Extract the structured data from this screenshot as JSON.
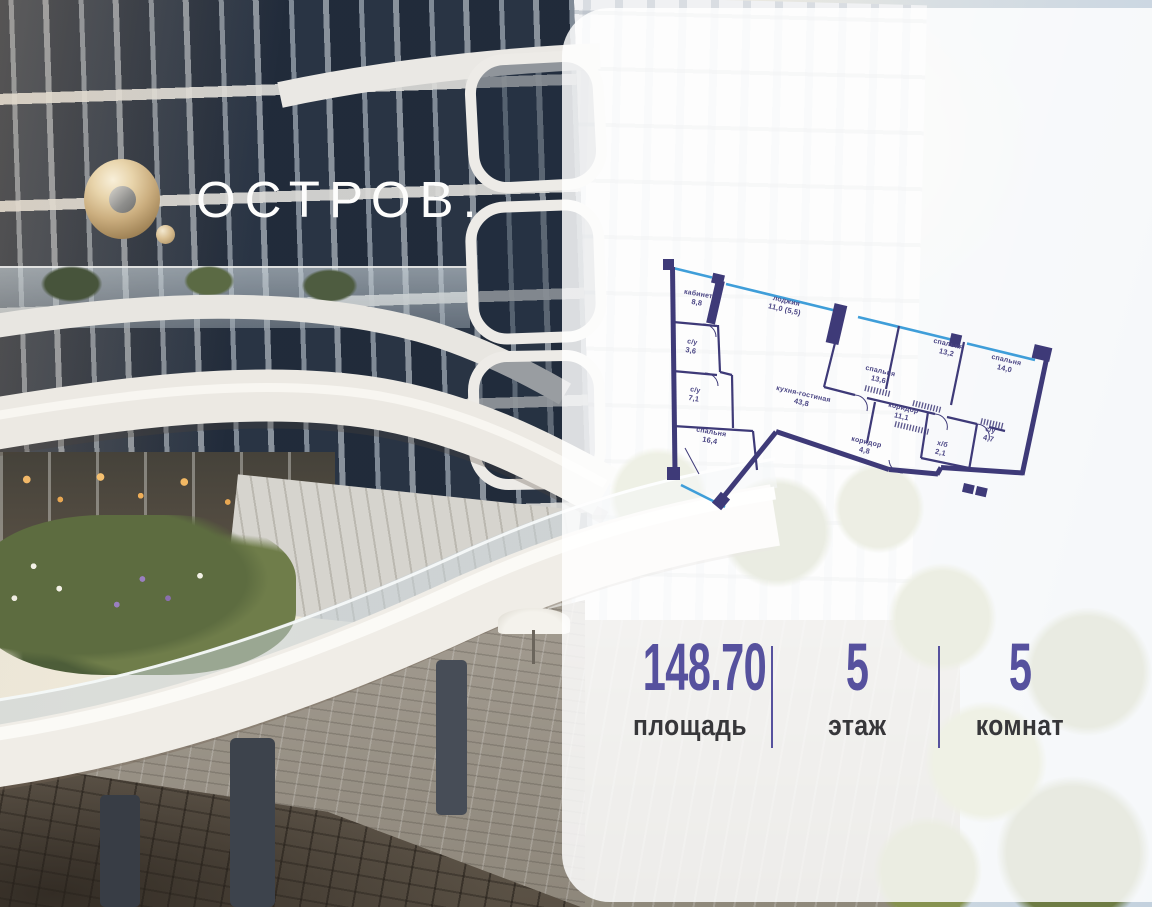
{
  "brand": {
    "wordmark": "ОСТРОВ."
  },
  "colors": {
    "wall": "#3e3a78",
    "window": "#3f9ed9",
    "accent": "#56519e",
    "room_label": "#4b4685",
    "stat_label": "#37373a",
    "gold": "#c9ab7e"
  },
  "floorplan": {
    "rooms": [
      {
        "name": "кабинет",
        "area": "8,8"
      },
      {
        "name": "лоджия",
        "area": "11,0 (5,5)"
      },
      {
        "name": "с/у",
        "area": "3,6"
      },
      {
        "name": "с/у",
        "area": "7,1"
      },
      {
        "name": "спальня",
        "area": "16,4"
      },
      {
        "name": "кухня-гостиная",
        "area": "43,8"
      },
      {
        "name": "спальня",
        "area": "13,6"
      },
      {
        "name": "спальня",
        "area": "13,2"
      },
      {
        "name": "спальня",
        "area": "14,0"
      },
      {
        "name": "коридор",
        "area": "11,1"
      },
      {
        "name": "коридор",
        "area": "4,8"
      },
      {
        "name": "х/б",
        "area": "2,1"
      },
      {
        "name": "с/у",
        "area": "4,7"
      }
    ]
  },
  "stats": [
    {
      "value": "148.70",
      "label": "площадь"
    },
    {
      "value": "5",
      "label": "этаж"
    },
    {
      "value": "5",
      "label": "комнат"
    }
  ]
}
